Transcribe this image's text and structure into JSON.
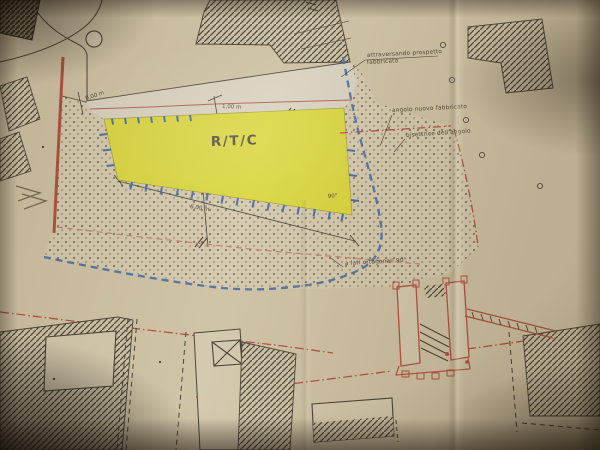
{
  "plan": {
    "building_label": "R/T/C",
    "labels": {
      "attraversamento_line1": "attraversando prospetto",
      "attraversamento_line2": "fabbricato",
      "angolo": "angolo nuovo fabbricato",
      "bisettrice": "bisettrice dell'angolo",
      "ortogonali": "a lati ortogonali 90°"
    },
    "dimensions": {
      "zero": "0,00 m",
      "one": "1,00 m",
      "six": "6,00 m",
      "right_angle": "90°"
    },
    "colors": {
      "paper": "#cdc0a2",
      "highlight_yellow": "#d9d52f",
      "blue_boundary": "#3a68aa",
      "red_line": "#ad3a2c",
      "red_dashdot": "#b5473a",
      "pink_dash": "#c27b70",
      "ink": "#3f382c"
    }
  }
}
